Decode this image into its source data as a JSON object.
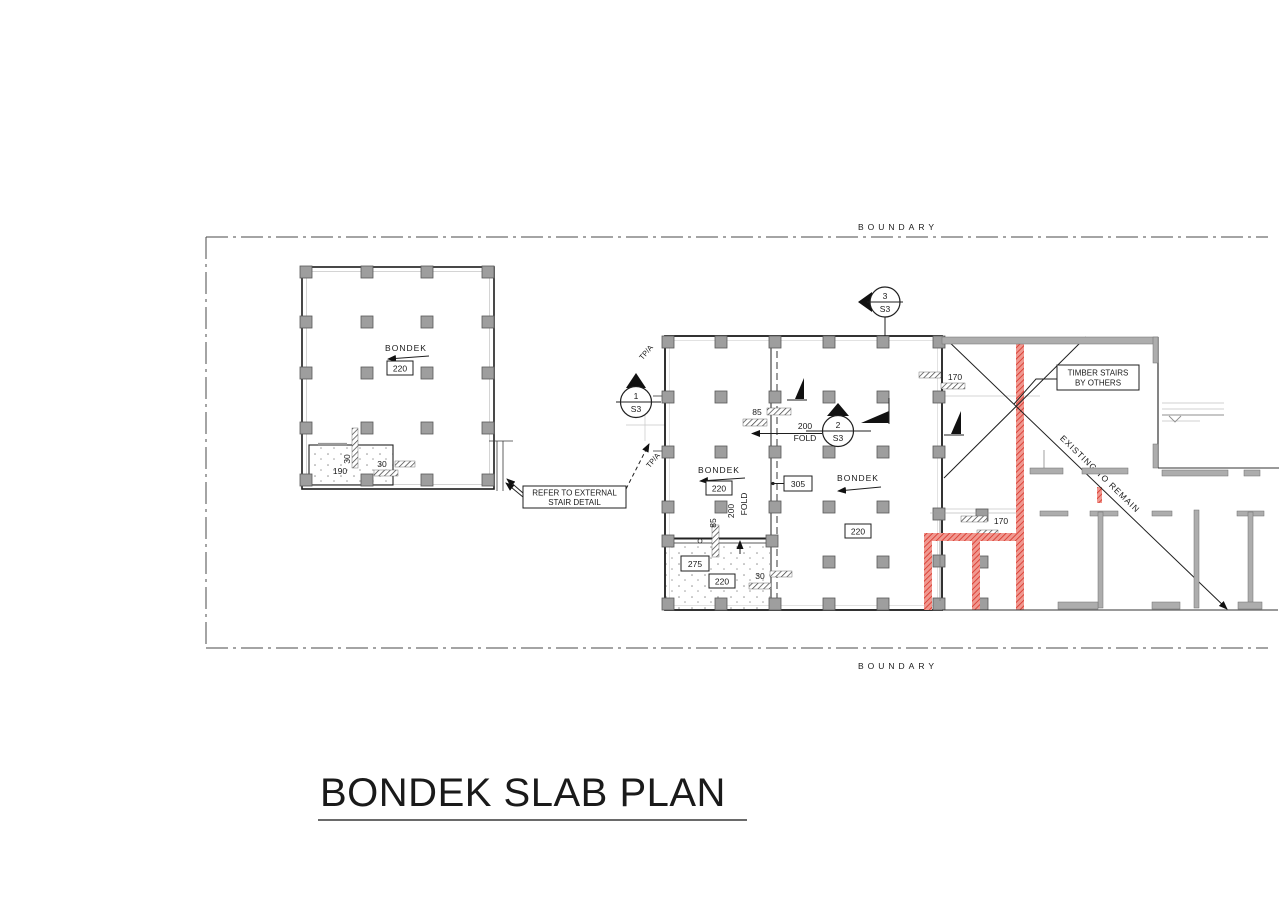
{
  "title": "BONDEK SLAB PLAN",
  "boundary": {
    "top": "BOUNDARY",
    "bottom": "BOUNDARY"
  },
  "colors": {
    "red_wall": "#d8352a",
    "red_wall_light": "#f09890",
    "wall_gray": "#adadad",
    "column_gray": "#9e9e9e",
    "line_dark": "#1f1f1f"
  },
  "left_building": {
    "bondek": "BONDEK",
    "slab_thickness": "220",
    "dim_wall_a": "30",
    "dim_wall_b": "30",
    "dim_step": "190"
  },
  "external_stair_callout": {
    "line1": "REFER TO EXTERNAL",
    "line2": "STAIR DETAIL"
  },
  "grid": {
    "tpa_top": "TP/A",
    "tpa_bottom": "TP/A"
  },
  "sections": {
    "s1": {
      "num": "1",
      "sheet": "S3"
    },
    "s2": {
      "num": "2",
      "sheet": "S3"
    },
    "s3": {
      "num": "3",
      "sheet": "S3"
    }
  },
  "main_building": {
    "bondek_left": "BONDEK",
    "slab_left": "220",
    "bondek_right": "BONDEK",
    "slab_right": "220",
    "dim_85_top": "85",
    "fold_h_value": "200",
    "fold_h_word": "FOLD",
    "dim_305": "305",
    "dim_85_left": "85",
    "fold_v_value": "200",
    "fold_v_word": "FOLD",
    "dim_170_top": "170",
    "dim_170_mid": "170",
    "dim_275": "275",
    "slab_bottom": "220",
    "dim_30": "30"
  },
  "timber_callout": {
    "line1": "TIMBER STAIRS",
    "line2": "BY OTHERS"
  },
  "existing_note": "EXISTING TO REMAIN"
}
